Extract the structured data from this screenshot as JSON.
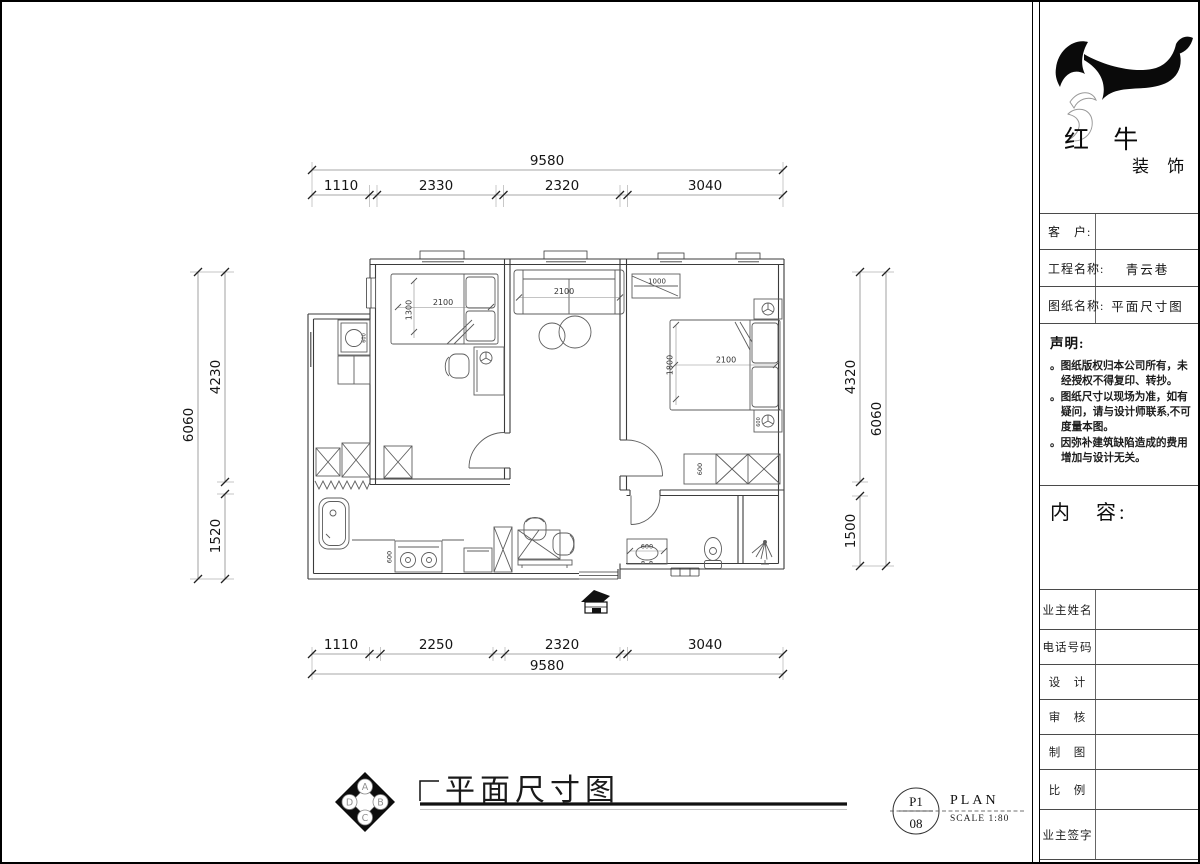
{
  "colors": {
    "paper": "#ffffff",
    "ink": "#000000",
    "wall_line": "#3b3b3b",
    "furniture_line": "#5d5d5d",
    "dim_text": "#151515"
  },
  "title_block": {
    "company": {
      "name_main": "红 牛",
      "name_sub": "装 饰"
    },
    "fields": [
      {
        "label": "客　户:",
        "value": ""
      },
      {
        "label": "工程名称:",
        "value": "青云巷"
      },
      {
        "label": "图纸名称:",
        "value": "平面尺寸图"
      }
    ],
    "statement": {
      "heading": "声明:",
      "items": [
        "。图纸版权归本公司所有，未经授权不得复印、转抄。",
        "。图纸尺寸以现场为准，如有疑问，请与设计师联系,不可度量本图。",
        "。因弥补建筑缺陷造成的费用增加与设计无关。"
      ]
    },
    "content_heading": "内　容:",
    "signature_rows": [
      "业主姓名",
      "电话号码",
      "设　计",
      "审　核",
      "制　图",
      "比　例",
      "业主签字"
    ]
  },
  "drawing": {
    "title": "平面尺寸图",
    "stamp": {
      "page": "P1",
      "total": "08",
      "name": "PLAN",
      "scale": "SCALE 1:80"
    },
    "compass": {
      "top": "A",
      "right": "B",
      "bottom": "C",
      "left": "D"
    },
    "dimensions": {
      "top": {
        "overall": "9580",
        "segments": [
          "1110",
          "2330",
          "2320",
          "3040"
        ]
      },
      "bottom": {
        "overall": "9580",
        "segments": [
          "1110",
          "2250",
          "2320",
          "3040"
        ]
      },
      "left": {
        "overall": "6060",
        "segments": [
          "4230",
          "1520"
        ]
      },
      "right": {
        "overall": "6060",
        "segments": [
          "4320",
          "1500"
        ]
      }
    },
    "furniture_labels": {
      "bed1_width": "2100",
      "bed1_depth": "1300",
      "sofa_width": "2100",
      "wardrobe_width": "1000",
      "bed2_width": "2100",
      "bed2_depth": "1800",
      "washer": "600",
      "stove": "600",
      "vanity": "600",
      "nightstand": "600",
      "cabinet": "600"
    }
  }
}
